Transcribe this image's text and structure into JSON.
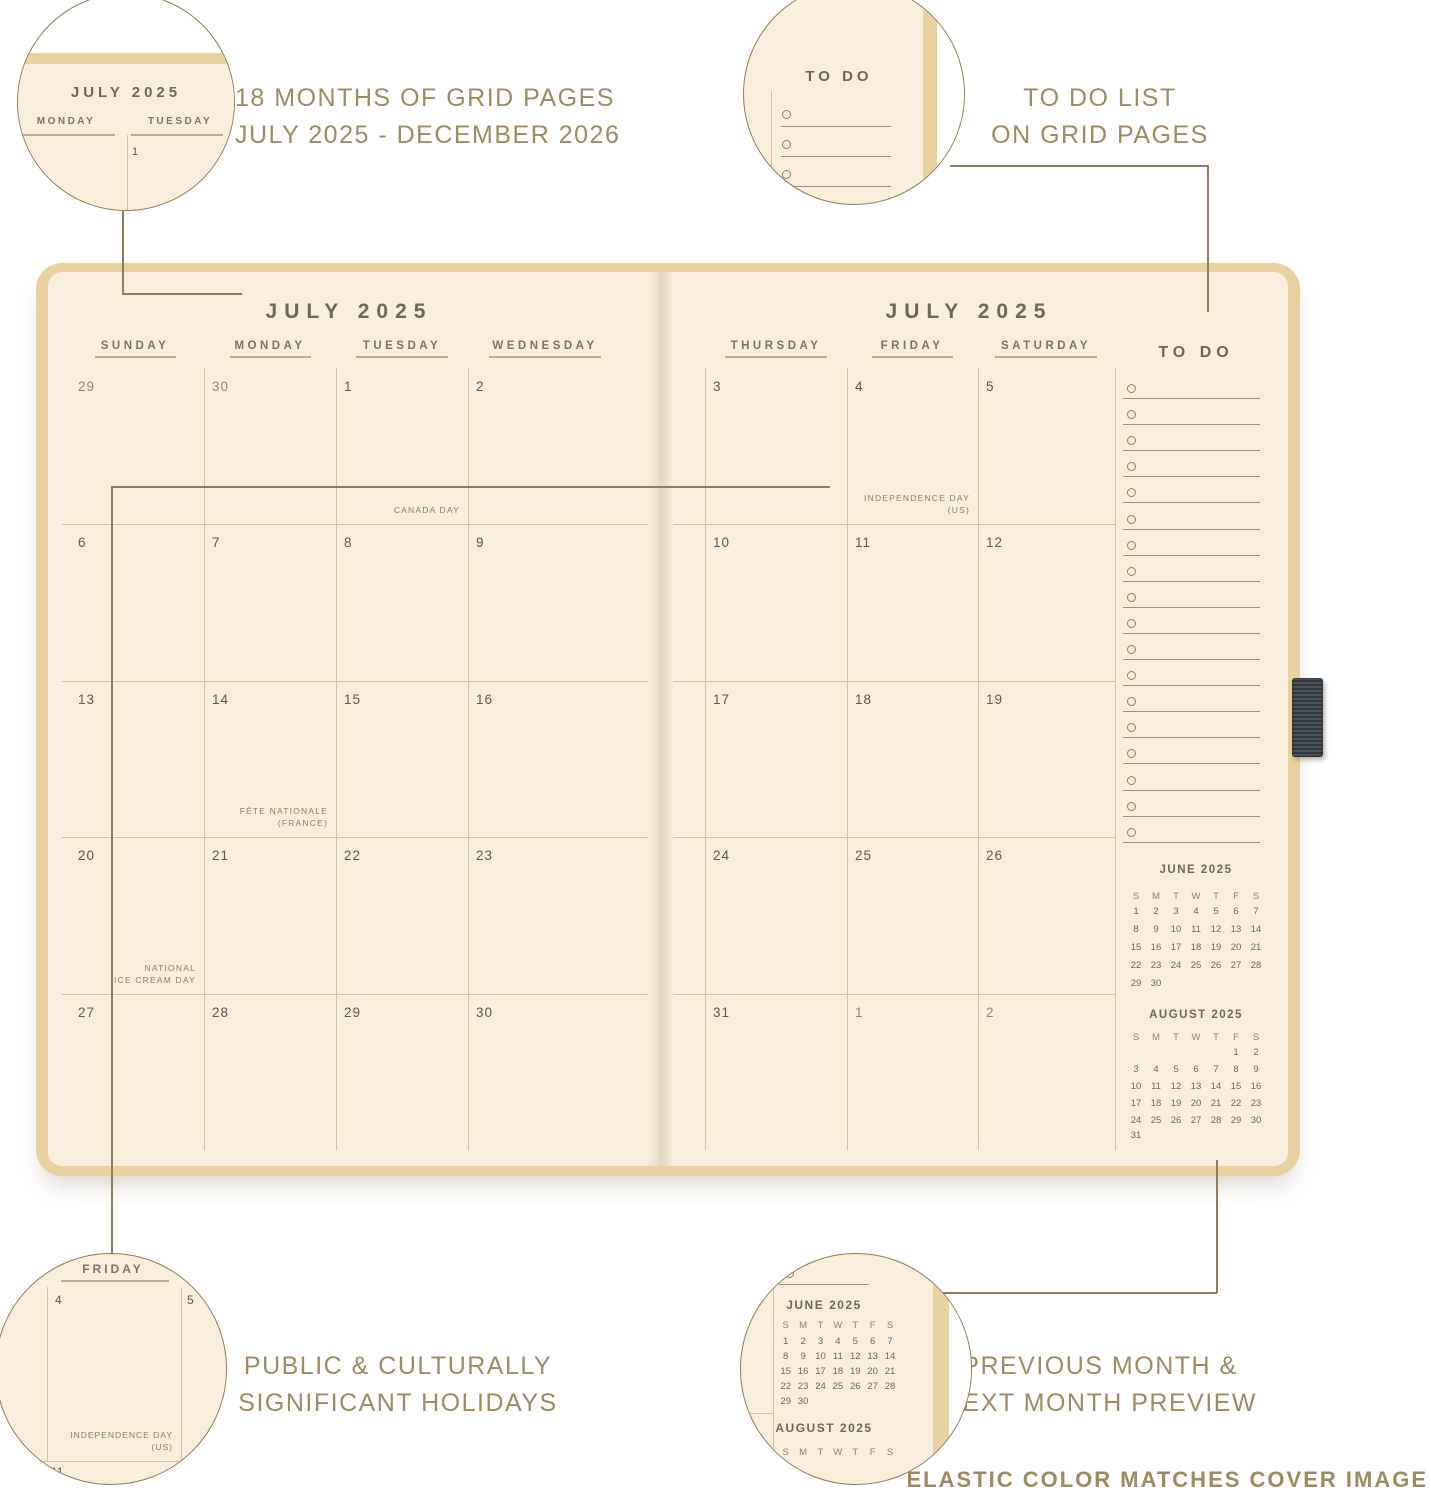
{
  "colors": {
    "cover": "#e9d2a0",
    "page": "#f8eedb",
    "grid_line": "#cfc2a8",
    "underline": "#b9ab8e",
    "title_text": "#6c675d",
    "day_header_text": "#7b7565",
    "date_text": "#5f594c",
    "muted_date_text": "#8f8776",
    "holiday_text": "#8a8168",
    "caption_text": "#9d8b62",
    "connector": "#8f7e57",
    "pen_loop": "#3f464b"
  },
  "callouts": {
    "top_left": {
      "lines": [
        "18 MONTHS OF GRID PAGES",
        "JULY 2025 - DECEMBER 2026"
      ]
    },
    "top_right": {
      "lines": [
        "TO DO LIST",
        "ON GRID PAGES"
      ]
    },
    "bottom_left": {
      "lines": [
        "PUBLIC & CULTURALLY",
        "SIGNIFICANT HOLIDAYS"
      ]
    },
    "bottom_right": {
      "lines": [
        "PREVIOUS MONTH &",
        "NEXT MONTH PREVIEW"
      ]
    },
    "bottom_note": "ELASTIC COLOR MATCHES COVER IMAGE"
  },
  "zoom_circles": {
    "top_left": {
      "month_title": "JULY 2025",
      "day_headers": [
        "MONDAY",
        "TUESDAY"
      ],
      "date": "1"
    },
    "top_right": {
      "todo_title": "TO DO",
      "item_count": 5
    },
    "bottom_left": {
      "day_header": "FRIDAY",
      "dates": [
        "4",
        "5",
        "11"
      ],
      "holiday": [
        "INDEPENDENCE DAY",
        "(US)"
      ]
    },
    "bottom_right": {
      "june_title": "JUNE 2025",
      "august_title": "AUGUST 2025"
    }
  },
  "spread": {
    "left_title": "JULY 2025",
    "right_title": "JULY 2025",
    "left_day_headers": [
      "SUNDAY",
      "MONDAY",
      "TUESDAY",
      "WEDNESDAY"
    ],
    "right_day_headers": [
      "THURSDAY",
      "FRIDAY",
      "SATURDAY"
    ],
    "todo_title": "TO DO",
    "todo_item_count": 18,
    "weeks": [
      {
        "left": [
          {
            "d": "29",
            "muted": true
          },
          {
            "d": "30",
            "muted": true
          },
          {
            "d": "1",
            "holiday": [
              "CANADA DAY"
            ]
          },
          {
            "d": "2"
          }
        ],
        "right": [
          {
            "d": "3"
          },
          {
            "d": "4",
            "holiday": [
              "INDEPENDENCE DAY",
              "(US)"
            ]
          },
          {
            "d": "5"
          }
        ]
      },
      {
        "left": [
          {
            "d": "6"
          },
          {
            "d": "7"
          },
          {
            "d": "8"
          },
          {
            "d": "9"
          }
        ],
        "right": [
          {
            "d": "10"
          },
          {
            "d": "11"
          },
          {
            "d": "12"
          }
        ]
      },
      {
        "left": [
          {
            "d": "13"
          },
          {
            "d": "14",
            "holiday": [
              "FÊTE NATIONALE",
              "(FRANCE)"
            ]
          },
          {
            "d": "15"
          },
          {
            "d": "16"
          }
        ],
        "right": [
          {
            "d": "17"
          },
          {
            "d": "18"
          },
          {
            "d": "19"
          }
        ]
      },
      {
        "left": [
          {
            "d": "20",
            "holiday": [
              "NATIONAL",
              "ICE CREAM DAY"
            ]
          },
          {
            "d": "21"
          },
          {
            "d": "22"
          },
          {
            "d": "23"
          }
        ],
        "right": [
          {
            "d": "24"
          },
          {
            "d": "25"
          },
          {
            "d": "26"
          }
        ]
      },
      {
        "left": [
          {
            "d": "27"
          },
          {
            "d": "28"
          },
          {
            "d": "29"
          },
          {
            "d": "30"
          }
        ],
        "right": [
          {
            "d": "31"
          },
          {
            "d": "1",
            "muted": true
          },
          {
            "d": "2",
            "muted": true
          }
        ]
      }
    ],
    "mini_calendars": [
      {
        "title": "JUNE 2025",
        "day_letters": [
          "S",
          "M",
          "T",
          "W",
          "T",
          "F",
          "S"
        ],
        "weeks": [
          [
            "1",
            "2",
            "3",
            "4",
            "5",
            "6",
            "7"
          ],
          [
            "8",
            "9",
            "10",
            "11",
            "12",
            "13",
            "14"
          ],
          [
            "15",
            "16",
            "17",
            "18",
            "19",
            "20",
            "21"
          ],
          [
            "22",
            "23",
            "24",
            "25",
            "26",
            "27",
            "28"
          ],
          [
            "29",
            "30",
            "",
            "",
            "",
            "",
            ""
          ]
        ]
      },
      {
        "title": "AUGUST 2025",
        "day_letters": [
          "S",
          "M",
          "T",
          "W",
          "T",
          "F",
          "S"
        ],
        "weeks": [
          [
            "",
            "",
            "",
            "",
            "",
            "1",
            "2"
          ],
          [
            "3",
            "4",
            "5",
            "6",
            "7",
            "8",
            "9"
          ],
          [
            "10",
            "11",
            "12",
            "13",
            "14",
            "15",
            "16"
          ],
          [
            "17",
            "18",
            "19",
            "20",
            "21",
            "22",
            "23"
          ],
          [
            "24",
            "25",
            "26",
            "27",
            "28",
            "29",
            "30"
          ],
          [
            "31",
            "",
            "",
            "",
            "",
            "",
            ""
          ]
        ]
      }
    ]
  }
}
